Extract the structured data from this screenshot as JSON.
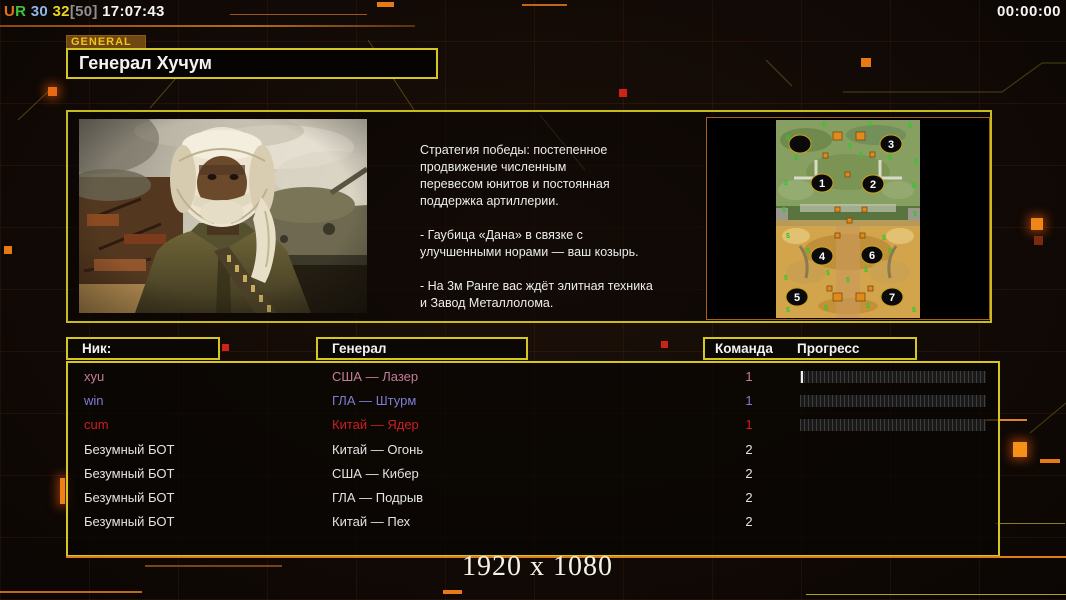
{
  "hud": {
    "top_left_parts": [
      {
        "text": "U",
        "color": "#e0741a"
      },
      {
        "text": "R",
        "color": "#3fc43f"
      },
      {
        "text": " 30",
        "color": "#8fb7ea"
      },
      {
        "text": " 32",
        "color": "#ead61e"
      },
      {
        "text": "[50]",
        "color": "#8f8f8f"
      },
      {
        "text": " 17:07:43",
        "color": "#f5f5f5"
      }
    ],
    "top_right_timer": "00:00:00",
    "resolution_label": "1920 x 1080"
  },
  "general_panel": {
    "tag": "GENERAL",
    "title": "Генерал Хучум",
    "strategy": {
      "p1": "Стратегия победы: постепенное\nпродвижение численным\nперевесом юнитов и постоянная\nподдержка артиллерии.",
      "p2": "- Гаубица «Дана» в связке с\nулучшенными норами — ваш козырь.",
      "p3": "- На 3м Ранге вас ждёт элитная техника\nи Завод Металлолома."
    },
    "map": {
      "markers": [
        {
          "label": "",
          "x": 24,
          "y": 24
        },
        {
          "label": "3",
          "x": 115,
          "y": 24
        },
        {
          "label": "1",
          "x": 46,
          "y": 63
        },
        {
          "label": "2",
          "x": 97,
          "y": 64
        },
        {
          "label": "4",
          "x": 46,
          "y": 136
        },
        {
          "label": "6",
          "x": 96,
          "y": 135
        },
        {
          "label": "5",
          "x": 21,
          "y": 177
        },
        {
          "label": "7",
          "x": 116,
          "y": 177
        }
      ],
      "resource_icon": "$",
      "resource_color": "#2ec82e",
      "resources": [
        {
          "x": 10,
          "y": 20
        },
        {
          "x": 46,
          "y": 7
        },
        {
          "x": 72,
          "y": 28
        },
        {
          "x": 92,
          "y": 6
        },
        {
          "x": 132,
          "y": 8
        },
        {
          "x": 18,
          "y": 40
        },
        {
          "x": 83,
          "y": 37
        },
        {
          "x": 112,
          "y": 40
        },
        {
          "x": 138,
          "y": 44
        },
        {
          "x": 8,
          "y": 65
        },
        {
          "x": 136,
          "y": 68
        },
        {
          "x": 6,
          "y": 92
        },
        {
          "x": 137,
          "y": 96
        },
        {
          "x": 10,
          "y": 118
        },
        {
          "x": 106,
          "y": 120
        },
        {
          "x": 30,
          "y": 133
        },
        {
          "x": 112,
          "y": 133
        },
        {
          "x": 8,
          "y": 160
        },
        {
          "x": 50,
          "y": 155
        },
        {
          "x": 88,
          "y": 152
        },
        {
          "x": 70,
          "y": 162
        },
        {
          "x": 10,
          "y": 192
        },
        {
          "x": 48,
          "y": 190
        },
        {
          "x": 90,
          "y": 188
        },
        {
          "x": 136,
          "y": 192
        }
      ],
      "supplies_big": [
        {
          "x": 57,
          "y": 12
        },
        {
          "x": 80,
          "y": 12
        },
        {
          "x": 57,
          "y": 173
        },
        {
          "x": 80,
          "y": 173
        }
      ],
      "supplies_small": [
        {
          "x": 47,
          "y": 33
        },
        {
          "x": 94,
          "y": 32
        },
        {
          "x": 69,
          "y": 52
        },
        {
          "x": 59,
          "y": 87
        },
        {
          "x": 86,
          "y": 87
        },
        {
          "x": 71,
          "y": 98
        },
        {
          "x": 59,
          "y": 113
        },
        {
          "x": 84,
          "y": 113
        },
        {
          "x": 51,
          "y": 166
        },
        {
          "x": 92,
          "y": 166
        }
      ]
    }
  },
  "lobby": {
    "headers": {
      "nick": "Ник:",
      "general": "Генерал",
      "team": "Команда",
      "progress": "Прогресс"
    },
    "players": [
      {
        "nick": "xyu",
        "general": "США — Лазер",
        "team": "1",
        "color": "#c27d9b",
        "bar": true,
        "tick": true
      },
      {
        "nick": "win",
        "general": "ГЛА — Штурм",
        "team": "1",
        "color": "#7d7dd4",
        "bar": true,
        "tick": false
      },
      {
        "nick": "cum",
        "general": "Китай — Ядер",
        "team": "1",
        "color": "#cc1f1f",
        "bar": true,
        "tick": false
      },
      {
        "nick": "Безумный БОТ",
        "general": "Китай — Огонь",
        "team": "2",
        "color": "#e3e3e3",
        "bar": false,
        "tick": false
      },
      {
        "nick": "Безумный БОТ",
        "general": "США — Кибер",
        "team": "2",
        "color": "#e3e3e3",
        "bar": false,
        "tick": false
      },
      {
        "nick": "Безумный БОТ",
        "general": "ГЛА — Подрыв",
        "team": "2",
        "color": "#e3e3e3",
        "bar": false,
        "tick": false
      },
      {
        "nick": "Безумный БОТ",
        "general": "Китай — Пех",
        "team": "2",
        "color": "#e3e3e3",
        "bar": false,
        "tick": false
      }
    ]
  },
  "colors": {
    "panel_border": "#d6c622",
    "accent_orange": "#de7e16",
    "map_border": "#a5611d"
  }
}
